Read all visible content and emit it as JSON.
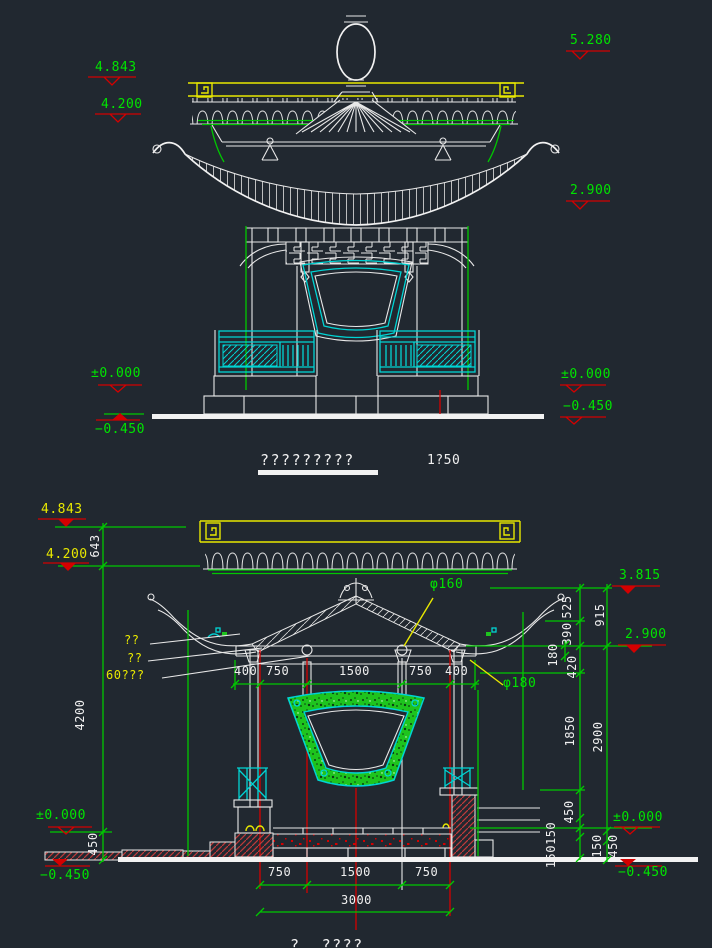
{
  "canvas": {
    "bg": "#212830"
  },
  "palette": {
    "line_white": "#e8e8e8",
    "dim_green": "#00c800",
    "text_green": "#00e400",
    "anno_yellow": "#e8e800",
    "detail_cyan": "#00d4d4",
    "marker_red": "#d40000",
    "fill_green": "#1ec41e"
  },
  "upper_view": {
    "title": "?????????",
    "scale_label": "1?50",
    "levels": {
      "left_top": "4.843",
      "left_mid": "4.200",
      "left_zero": "±0.000",
      "left_neg": "−0.450",
      "right_top": "5.280",
      "right_mid": "2.900",
      "right_zero": "±0.000",
      "right_neg": "−0.450"
    }
  },
  "lower_view": {
    "partial_title": "?  ????",
    "levels": {
      "left_top": "4.843",
      "left_mid": "4.200",
      "left_zero": "±0.000",
      "left_neg": "−0.450",
      "right_top": "3.815",
      "right_mid": "2.900",
      "right_zero": "±0.000",
      "right_neg": "−0.450"
    },
    "vdims": {
      "d643": "643",
      "d4200": "4200",
      "d450_left": "450",
      "d525": "525",
      "d390": "390",
      "d420": "420",
      "d180": "180",
      "d915": "915",
      "d1850": "1850",
      "d2900": "2900",
      "d450_right": "450",
      "d150150": "150150",
      "d150": "150",
      "d450_base": "450"
    },
    "hdims_top": {
      "a1": "400",
      "a2": "750",
      "a3": "1500",
      "a4": "750",
      "a5": "400"
    },
    "hdims_bottom": {
      "b1": "750",
      "b2": "1500",
      "b3": "750",
      "total": "3000"
    },
    "notes": {
      "n1": "??",
      "n2": "??",
      "n3": "60???"
    },
    "diameters": {
      "top": "φ160",
      "bottom": "φ180"
    }
  }
}
